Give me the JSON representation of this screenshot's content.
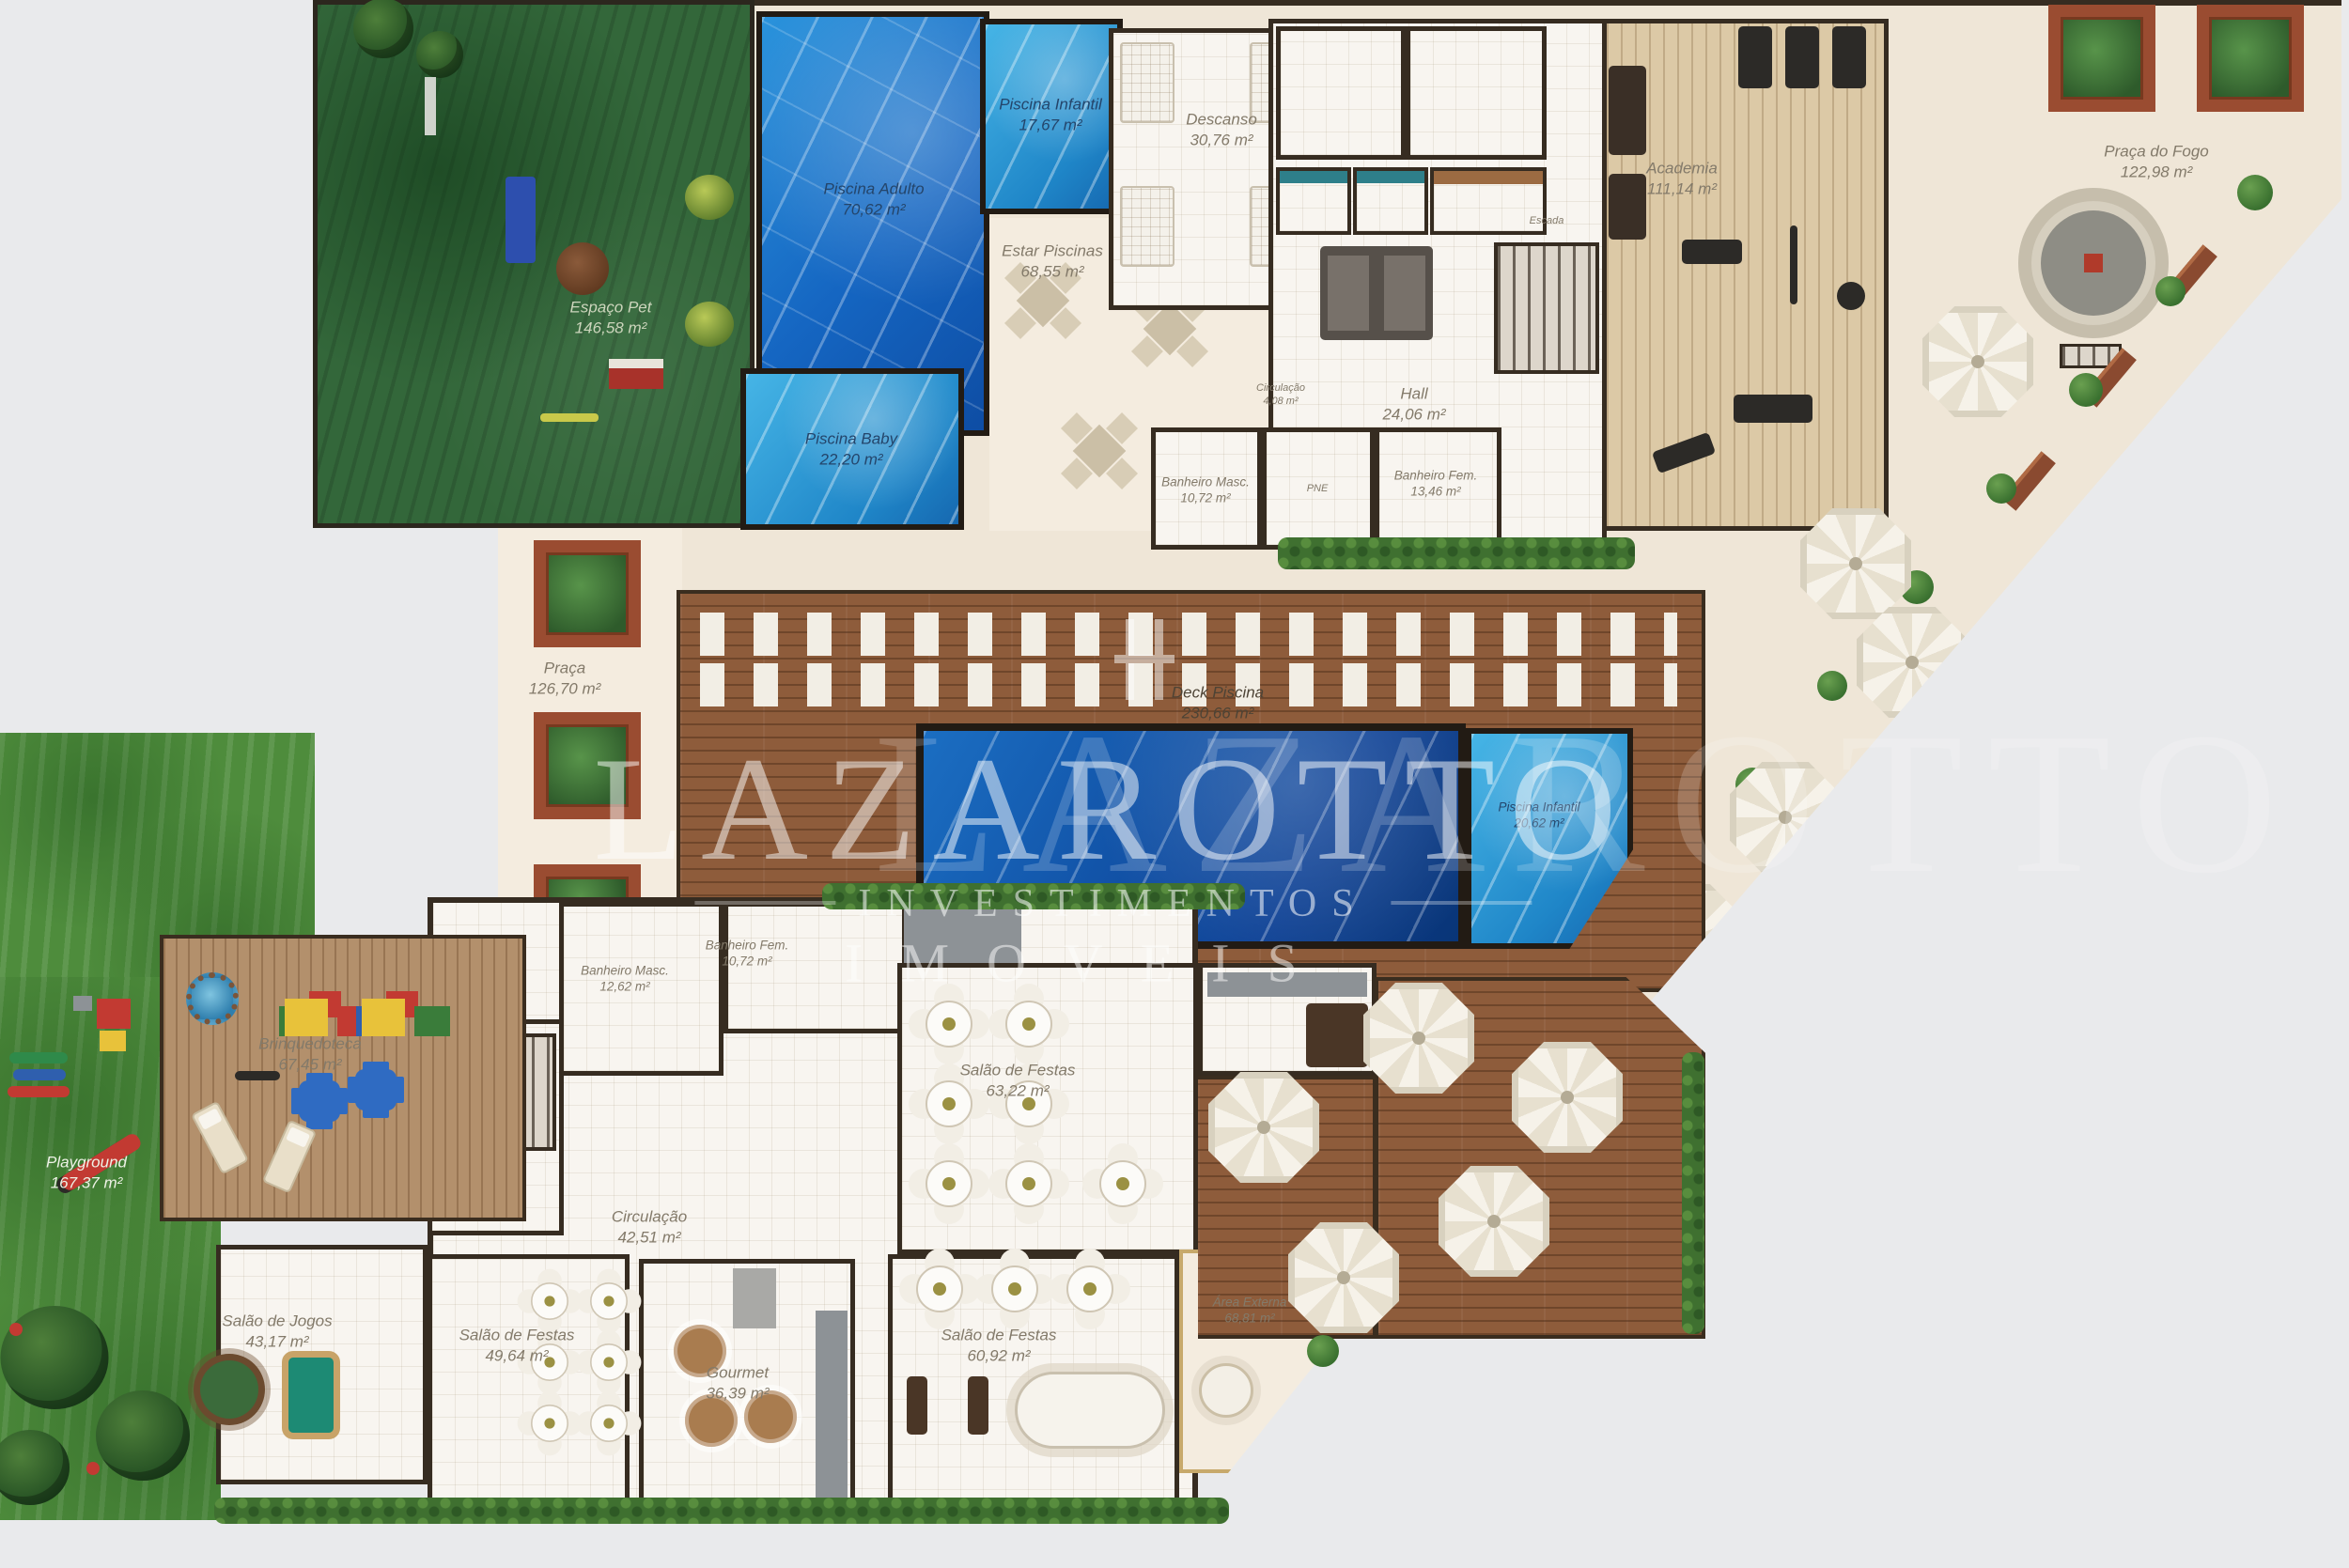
{
  "watermark": {
    "brand": "LAZAROTTO",
    "line2": "INVESTIMENTOS",
    "line3": "IMOVEIS"
  },
  "rooms": {
    "espaco_pet": {
      "name": "Espaço Pet",
      "area": "146,58 m²"
    },
    "praca": {
      "name": "Praça",
      "area": "126,70 m²"
    },
    "piscina_adulto": {
      "name": "Piscina Adulto",
      "area": "70,62 m²"
    },
    "piscina_infantil_top": {
      "name": "Piscina Infantil",
      "area": "17,67 m²"
    },
    "piscina_baby": {
      "name": "Piscina Baby",
      "area": "22,20 m²"
    },
    "estar_piscinas": {
      "name": "Estar Piscinas",
      "area": "68,55 m²"
    },
    "descanso": {
      "name": "Descanso",
      "area": "30,76 m²"
    },
    "hall": {
      "name": "Hall",
      "area": "24,06 m²"
    },
    "circulacao_pequena": {
      "name": "Circulação",
      "area": "4,08 m²"
    },
    "banheiro_masc_sup": {
      "name": "Banheiro Masc.",
      "area": "10,72 m²"
    },
    "pne": {
      "name": "PNE",
      "area": ""
    },
    "banheiro_fem_sup": {
      "name": "Banheiro Fem.",
      "area": "13,46 m²"
    },
    "escada": {
      "name": "Escada",
      "area": ""
    },
    "academia": {
      "name": "Academia",
      "area": "111,14 m²"
    },
    "praca_do_fogo": {
      "name": "Praça do Fogo",
      "area": "122,98 m²"
    },
    "deck_piscina": {
      "name": "Deck Piscina",
      "area": "230,66 m²"
    },
    "piscina_infantil_centro": {
      "name": "Piscina Infantil",
      "area": "20,62 m²"
    },
    "playground": {
      "name": "Playground",
      "area": "167,37 m²"
    },
    "brinquedoteca": {
      "name": "Brinquedoteca",
      "area": "67,45 m²"
    },
    "banheiro_masc_inf": {
      "name": "Banheiro Masc.",
      "area": "12,62 m²"
    },
    "banheiro_fem_inf": {
      "name": "Banheiro Fem.",
      "area": "10,72 m²"
    },
    "salao_festas_1": {
      "name": "Salão de Festas",
      "area": "63,22 m²"
    },
    "circulacao": {
      "name": "Circulação",
      "area": "42,51 m²"
    },
    "salao_jogos": {
      "name": "Salão de Jogos",
      "area": "43,17 m²"
    },
    "salao_festas_2": {
      "name": "Salão de Festas",
      "area": "49,64 m²"
    },
    "gourmet": {
      "name": "Gourmet",
      "area": "36,39 m²"
    },
    "salao_festas_3": {
      "name": "Salão de Festas",
      "area": "60,92 m²"
    },
    "area_externa": {
      "name": "Área Externa",
      "area": "68,81 m²"
    }
  }
}
